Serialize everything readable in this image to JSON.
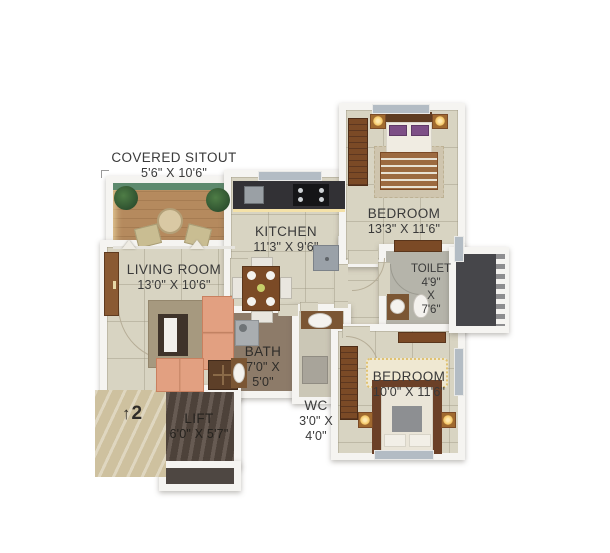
{
  "rooms": {
    "covered_sitout": {
      "name": "COVERED SITOUT",
      "dims": "5'6\" X 10'6\""
    },
    "living_room": {
      "name": "LIVING ROOM",
      "dims": "13'0\" X 10'6\""
    },
    "kitchen": {
      "name": "KITCHEN",
      "dims": "11'3\" X 9'6\""
    },
    "bedroom_top": {
      "name": "BEDROOM",
      "dims": "13'3\" X 11'6\""
    },
    "toilet": {
      "name": "TOILET",
      "dim1": "4'9\"",
      "dim2": "X",
      "dim3": "7'6\""
    },
    "bath": {
      "name": "BATH",
      "dim1": "7'0\" X",
      "dim2": "5'0\""
    },
    "wc": {
      "name": "WC",
      "dim1": "3'0\" X",
      "dim2": "4'0\""
    },
    "bedroom_bottom": {
      "name": "BEDROOM",
      "dims": "10'0\" X 11'6\""
    },
    "lift": {
      "name": "LIFT",
      "dims": "6'0\" X 5'7\""
    }
  },
  "markers": {
    "unit_number": "2",
    "direction_arrow": "↑"
  },
  "colors": {
    "wall": "#f5f4f1",
    "floor_tile": "#d8d4c2",
    "deck_wood": "#b58a5e",
    "glow": "#f4e1a8",
    "sofa": "#e2a081",
    "dark_wood": "#7b4a26",
    "bath_floor": "#8d7b69",
    "toilet_floor": "#b5b4aa",
    "duct": "#46464a",
    "lobby_marble": "#cec19f",
    "lift_floor": "#584b42",
    "window": "#b3bcc4",
    "pillow_purple": "#7d4f86",
    "label_text": "#3a3a3a"
  }
}
